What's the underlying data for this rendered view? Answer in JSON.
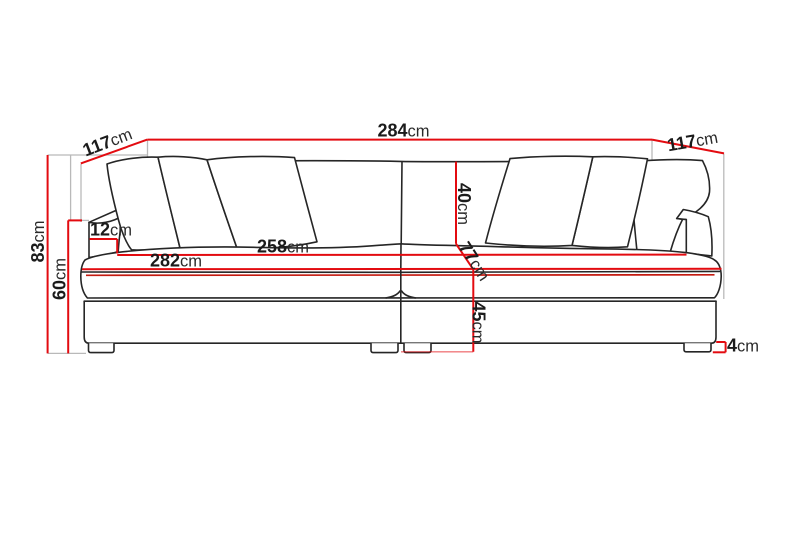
{
  "diagram": {
    "title": "sofa-dimension-drawing",
    "unit": "cm",
    "colors": {
      "dimension_line": "#e30b10",
      "sofa_outline": "#262626",
      "helper_line": "#b9b9b9",
      "background": "#ffffff",
      "text": "#1b1b1b"
    },
    "labels": {
      "overall_width": {
        "value": "284",
        "unit": "cm"
      },
      "depth_left": {
        "value": "117",
        "unit": "cm"
      },
      "depth_right": {
        "value": "117",
        "unit": "cm"
      },
      "overall_height": {
        "value": "83",
        "unit": "cm"
      },
      "arm_height": {
        "value": "60",
        "unit": "cm"
      },
      "arm_width": {
        "value": "12",
        "unit": "cm"
      },
      "inner_seat_width": {
        "value": "258",
        "unit": "cm"
      },
      "seat_width": {
        "value": "282",
        "unit": "cm"
      },
      "backrest_height": {
        "value": "40",
        "unit": "cm"
      },
      "seat_depth": {
        "value": "77",
        "unit": "cm"
      },
      "seat_height": {
        "value": "45",
        "unit": "cm"
      },
      "leg_height": {
        "value": "4",
        "unit": "cm"
      }
    }
  }
}
